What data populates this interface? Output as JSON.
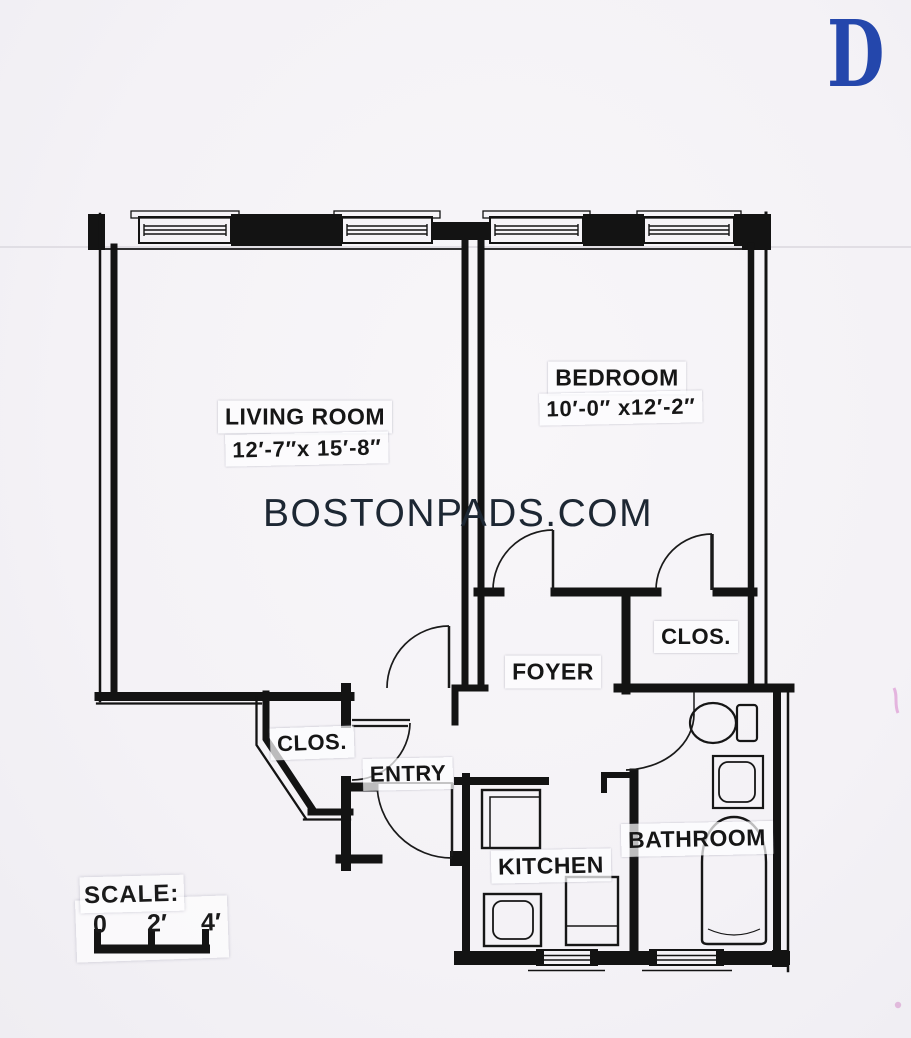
{
  "document": {
    "plan_letter": "D",
    "watermark": "BOSTONPADS.COM"
  },
  "rooms": {
    "living_room": {
      "name": "LIVING ROOM",
      "dimensions": "12′-7″x 15′-8″"
    },
    "bedroom": {
      "name": "BEDROOM",
      "dimensions": "10′-0″ x12′-2″"
    },
    "bedroom_closet": {
      "name": "CLOS."
    },
    "foyer": {
      "name": "FOYER"
    },
    "entry_closet": {
      "name": "CLOS."
    },
    "entry": {
      "name": "ENTRY"
    },
    "kitchen": {
      "name": "KITCHEN"
    },
    "bathroom": {
      "name": "BATHROOM"
    }
  },
  "scale_bar": {
    "label": "SCALE:",
    "tick_labels": [
      "0",
      "2′",
      "4′"
    ]
  },
  "fixtures": [
    "toilet",
    "bathroom-sink",
    "bathtub",
    "kitchen-stove",
    "kitchen-sink",
    "kitchen-counter"
  ],
  "colors": {
    "walls": "#131313",
    "paper": "#f5f3f6",
    "plan_letter_blue": "#2447ac",
    "watermark_navy": "#1d2733"
  }
}
